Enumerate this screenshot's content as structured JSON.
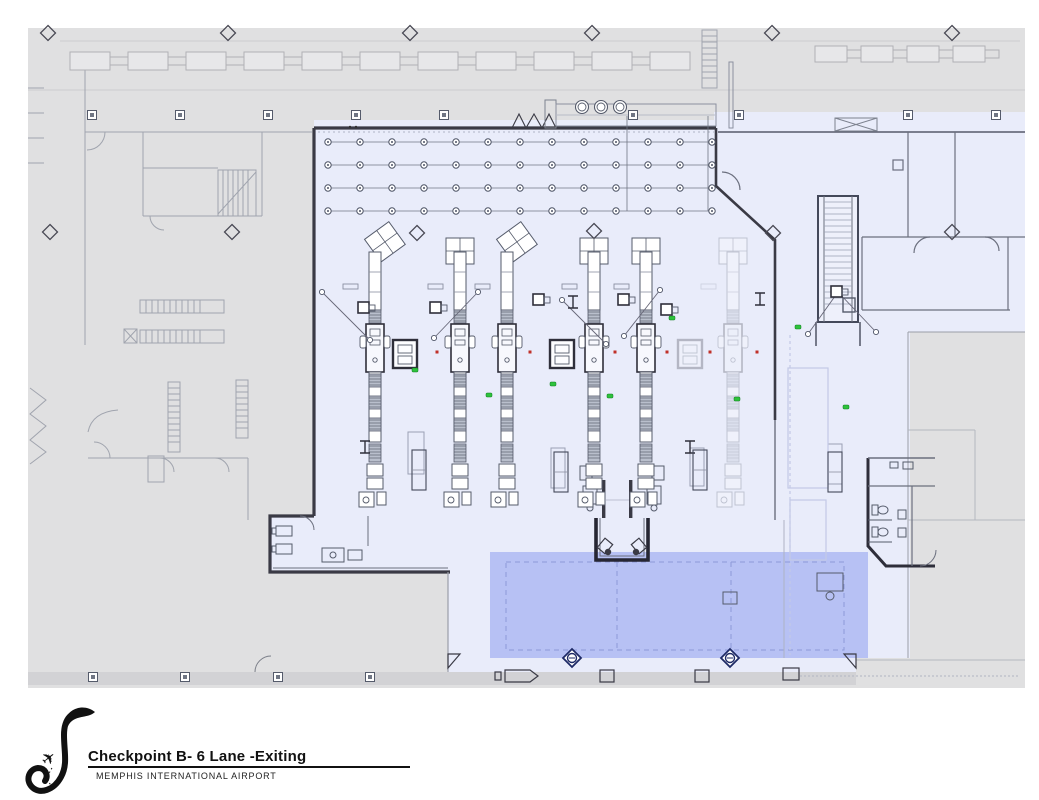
{
  "title_block": {
    "title": "Checkpoint B- 6 Lane -Exiting",
    "subtitle": "MEMPHIS INTERNATIONAL AIRPORT",
    "logo": "memphis-airport-swoosh-with-airplane"
  },
  "colors": {
    "page": "#ffffff",
    "plan_gray": "#e0e0e1",
    "plan_gray_dark": "#d2d2d5",
    "secure_area": "#e9ecfa",
    "exit_overlay": "#b7c1f4",
    "overlay_dash": "#8d99d8",
    "wall": "#3a3a45",
    "line": "#6b6f7e",
    "light_line": "#a9adb8",
    "ghost": "#9aa3cf",
    "marker_green": "#2ec23c",
    "marker_red": "#c03028",
    "conveyor_fill": "#b9bfcc"
  },
  "plan": {
    "lanes": {
      "top_y": 252,
      "items": [
        {
          "x": 375,
          "ghost": false,
          "tables": "angled"
        },
        {
          "x": 460,
          "ghost": false,
          "tables": "straight"
        },
        {
          "x": 507,
          "ghost": false,
          "tables": "angled"
        },
        {
          "x": 594,
          "ghost": false,
          "tables": "straight"
        },
        {
          "x": 646,
          "ghost": false,
          "tables": "straight"
        },
        {
          "x": 733,
          "ghost": true,
          "tables": "straight"
        }
      ]
    },
    "body_scanners": [
      {
        "x": 405,
        "y": 340,
        "ghost": false
      },
      {
        "x": 562,
        "y": 340,
        "ghost": false
      },
      {
        "x": 690,
        "y": 340,
        "ghost": true
      }
    ],
    "stanchion_rows": {
      "ys": [
        142,
        165,
        188,
        211
      ],
      "x_start": 328,
      "count": 13,
      "step": 32
    },
    "vertical_grid_lines": {
      "xs": [
        627,
        708
      ],
      "y1": 116,
      "y2": 211
    },
    "column_diamonds": [
      [
        48,
        33
      ],
      [
        228,
        33
      ],
      [
        410,
        33
      ],
      [
        592,
        33
      ],
      [
        772,
        33
      ],
      [
        952,
        33
      ],
      [
        50,
        232
      ],
      [
        232,
        232
      ],
      [
        417,
        233
      ],
      [
        594,
        231
      ],
      [
        773,
        233
      ],
      [
        952,
        232
      ]
    ],
    "wall_posts": {
      "top": {
        "y": 115,
        "xs": [
          92,
          180,
          268,
          356,
          444,
          633,
          739,
          908,
          996
        ]
      },
      "bottom": {
        "y": 677,
        "xs": [
          93,
          185,
          278,
          370
        ]
      }
    },
    "column_circles": {
      "y": 107,
      "xs": [
        582,
        601,
        620
      ]
    },
    "counter_chains": [
      {
        "y": 52,
        "x1": 70,
        "x2": 700,
        "w": 40,
        "h": 18,
        "gap": 18
      },
      {
        "y": 46,
        "x1": 815,
        "x2": 1015,
        "w": 32,
        "h": 16,
        "gap": 14
      }
    ],
    "green_markers": [
      [
        415,
        370
      ],
      [
        489,
        395
      ],
      [
        553,
        384
      ],
      [
        610,
        396
      ],
      [
        672,
        318
      ],
      [
        798,
        327
      ],
      [
        846,
        407
      ],
      [
        737,
        399
      ]
    ],
    "red_markers": [
      [
        437,
        352
      ],
      [
        530,
        352
      ],
      [
        615,
        352
      ],
      [
        667,
        352
      ],
      [
        710,
        352
      ],
      [
        757,
        352
      ]
    ],
    "queue_diagonals": [
      [
        322,
        292,
        370,
        340
      ],
      [
        478,
        292,
        434,
        338
      ],
      [
        562,
        300,
        606,
        344
      ],
      [
        660,
        290,
        624,
        336
      ],
      [
        838,
        292,
        808,
        334
      ],
      [
        838,
        292,
        876,
        332
      ]
    ],
    "queue_signs": [
      [
        365,
        308
      ],
      [
        437,
        308
      ],
      [
        540,
        300
      ],
      [
        625,
        300
      ],
      [
        668,
        310
      ],
      [
        838,
        292
      ]
    ],
    "info_symbols": [
      [
        573,
        302
      ],
      [
        760,
        299
      ],
      [
        365,
        447
      ],
      [
        690,
        447
      ]
    ],
    "bin_carts": [
      [
        412,
        450
      ],
      [
        554,
        452
      ],
      [
        693,
        450
      ],
      [
        828,
        452
      ]
    ],
    "exit_bollards": [
      [
        572,
        658
      ],
      [
        730,
        658
      ]
    ],
    "ceiling_dots": [
      [
        350,
        127
      ],
      [
        356,
        127
      ]
    ]
  }
}
